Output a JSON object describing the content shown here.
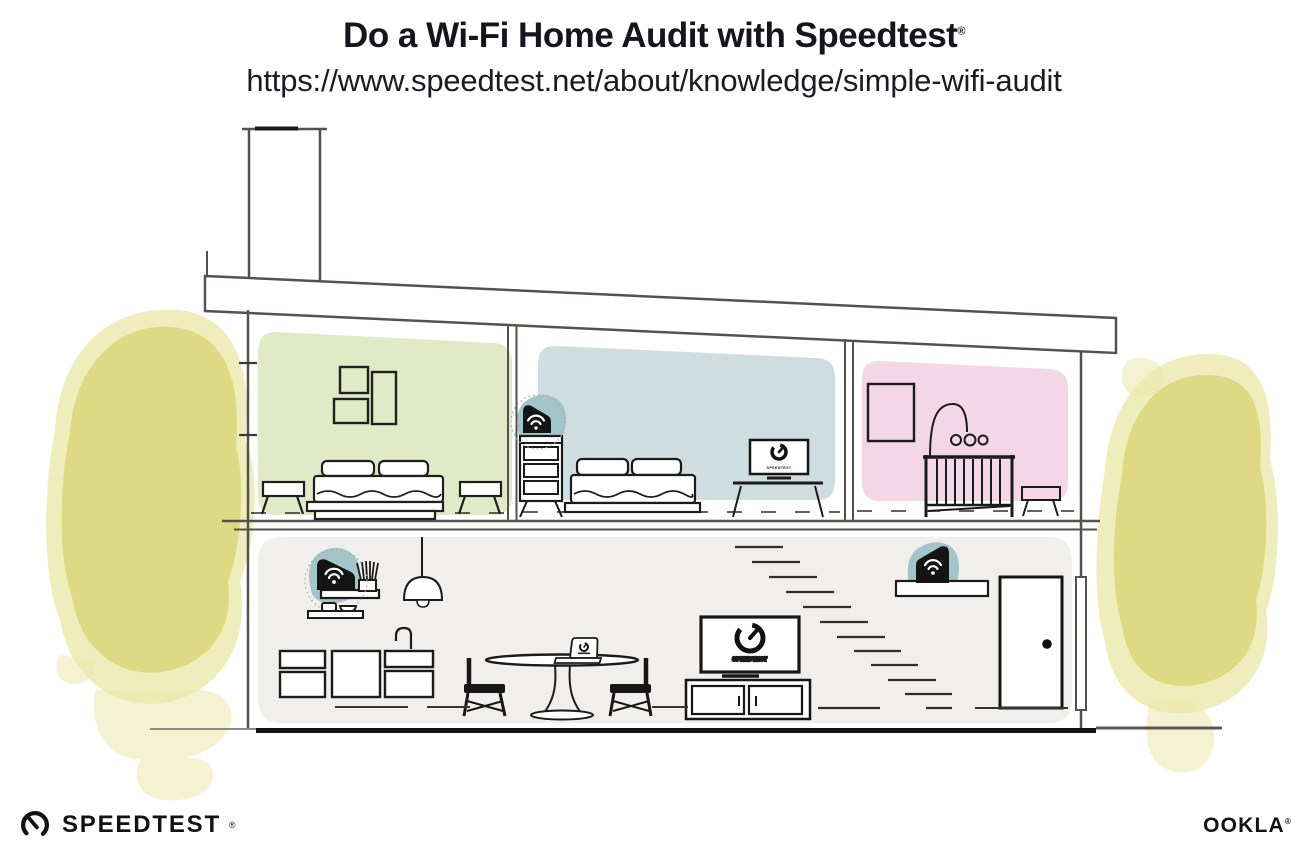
{
  "header": {
    "title": "Do a Wi-Fi Home Audit with Speedtest",
    "registered": "®",
    "url": "https://www.speedtest.net/about/knowledge/simple-wifi-audit"
  },
  "screens": {
    "tv_label": "SPEEDTEST",
    "monitor_label": "SPEEDTEST"
  },
  "footer": {
    "speedtest": "SPEEDTEST",
    "speedtest_registered": "®",
    "ookla": "OOKLA",
    "ookla_registered": "®"
  },
  "colors": {
    "bedroom_green": "#e1e9c6",
    "bedroom_blue": "#cedde0",
    "nursery_pink": "#f3d7e7",
    "ground_floor": "#f0efec",
    "wifi_teal": "#a3c5c9",
    "tree_core": "#dcd87e",
    "tree_halo": "#ebe8aa",
    "ink": "#1b1b1b",
    "structure": "#55524d"
  }
}
